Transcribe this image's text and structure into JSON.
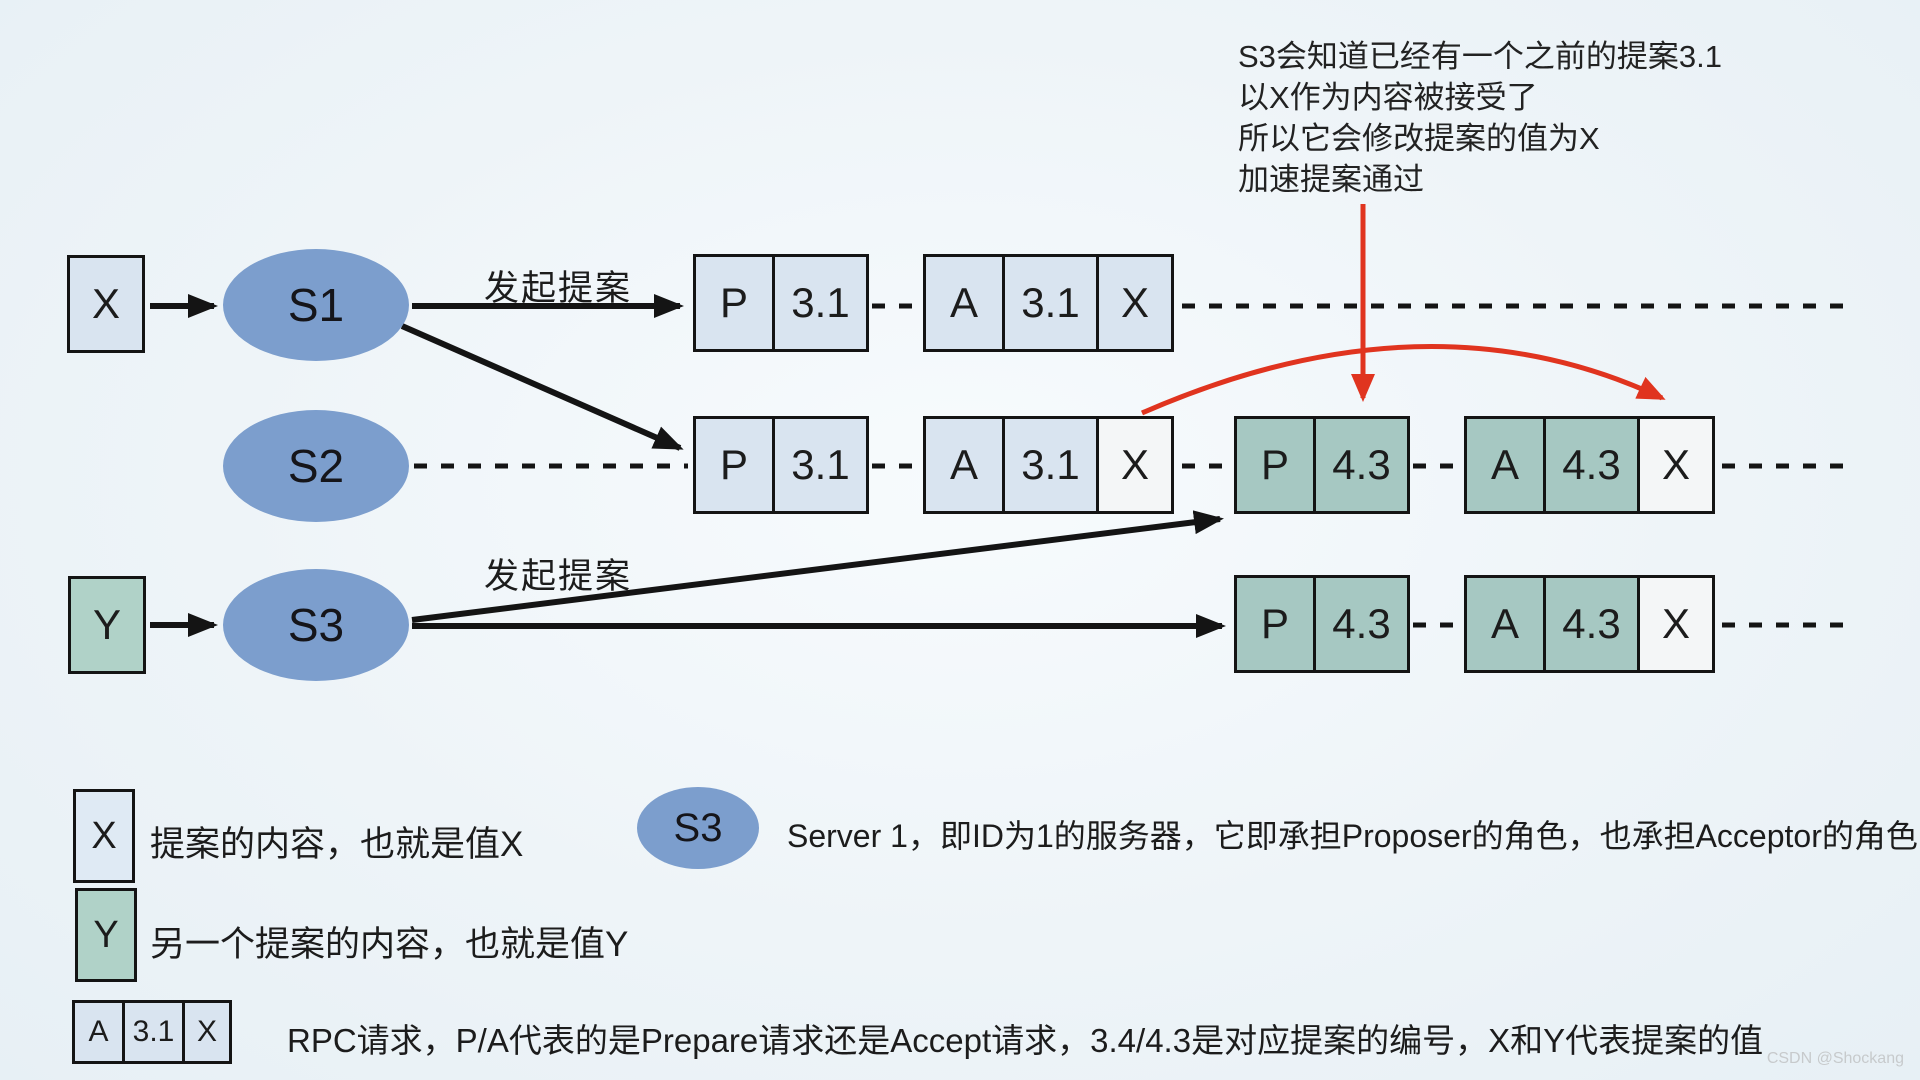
{
  "diagram": {
    "row1": {
      "value_box": "X",
      "server": "S1",
      "action_label": "发起提案",
      "prepare": {
        "type": "P",
        "num": "3.1"
      },
      "accept": {
        "type": "A",
        "num": "3.1",
        "value": "X"
      }
    },
    "row2": {
      "server": "S2",
      "prepare1": {
        "type": "P",
        "num": "3.1"
      },
      "accept1": {
        "type": "A",
        "num": "3.1",
        "value": "X"
      },
      "prepare2": {
        "type": "P",
        "num": "4.3"
      },
      "accept2": {
        "type": "A",
        "num": "4.3",
        "value": "X"
      }
    },
    "row3": {
      "value_box": "Y",
      "server": "S3",
      "action_label": "发起提案",
      "prepare": {
        "type": "P",
        "num": "4.3"
      },
      "accept": {
        "type": "A",
        "num": "4.3",
        "value": "X"
      }
    }
  },
  "annotation": {
    "line1": "S3会知道已经有一个之前的提案3.1",
    "line2": "以X作为内容被接受了",
    "line3": "所以它会修改提案的值为X",
    "line4": "加速提案通过"
  },
  "legend": {
    "x_box": "X",
    "x_text": "提案的内容，也就是值X",
    "server_ellipse": "S3",
    "server_text": "Server 1，即ID为1的服务器，它即承担Proposer的角色，也承担Acceptor的角色",
    "y_box": "Y",
    "y_text": "另一个提案的内容，也就是值Y",
    "rpc_box": {
      "type": "A",
      "num": "3.1",
      "value": "X"
    },
    "rpc_text": "RPC请求，P/A代表的是Prepare请求还是Accept请求，3.4/4.3是对应提案的编号，X和Y代表提案的值"
  },
  "watermark": "CSDN @Shockang",
  "colors": {
    "background": "#eef4f8",
    "cell_light_blue": "#d9e4f0",
    "cell_teal": "#a6c8c2",
    "cell_white": "#f4f6f7",
    "value_teal": "#b0d2c8",
    "ellipse_blue": "#7c9ecd",
    "line_black": "#141414",
    "arrow_red": "#e0341f"
  }
}
